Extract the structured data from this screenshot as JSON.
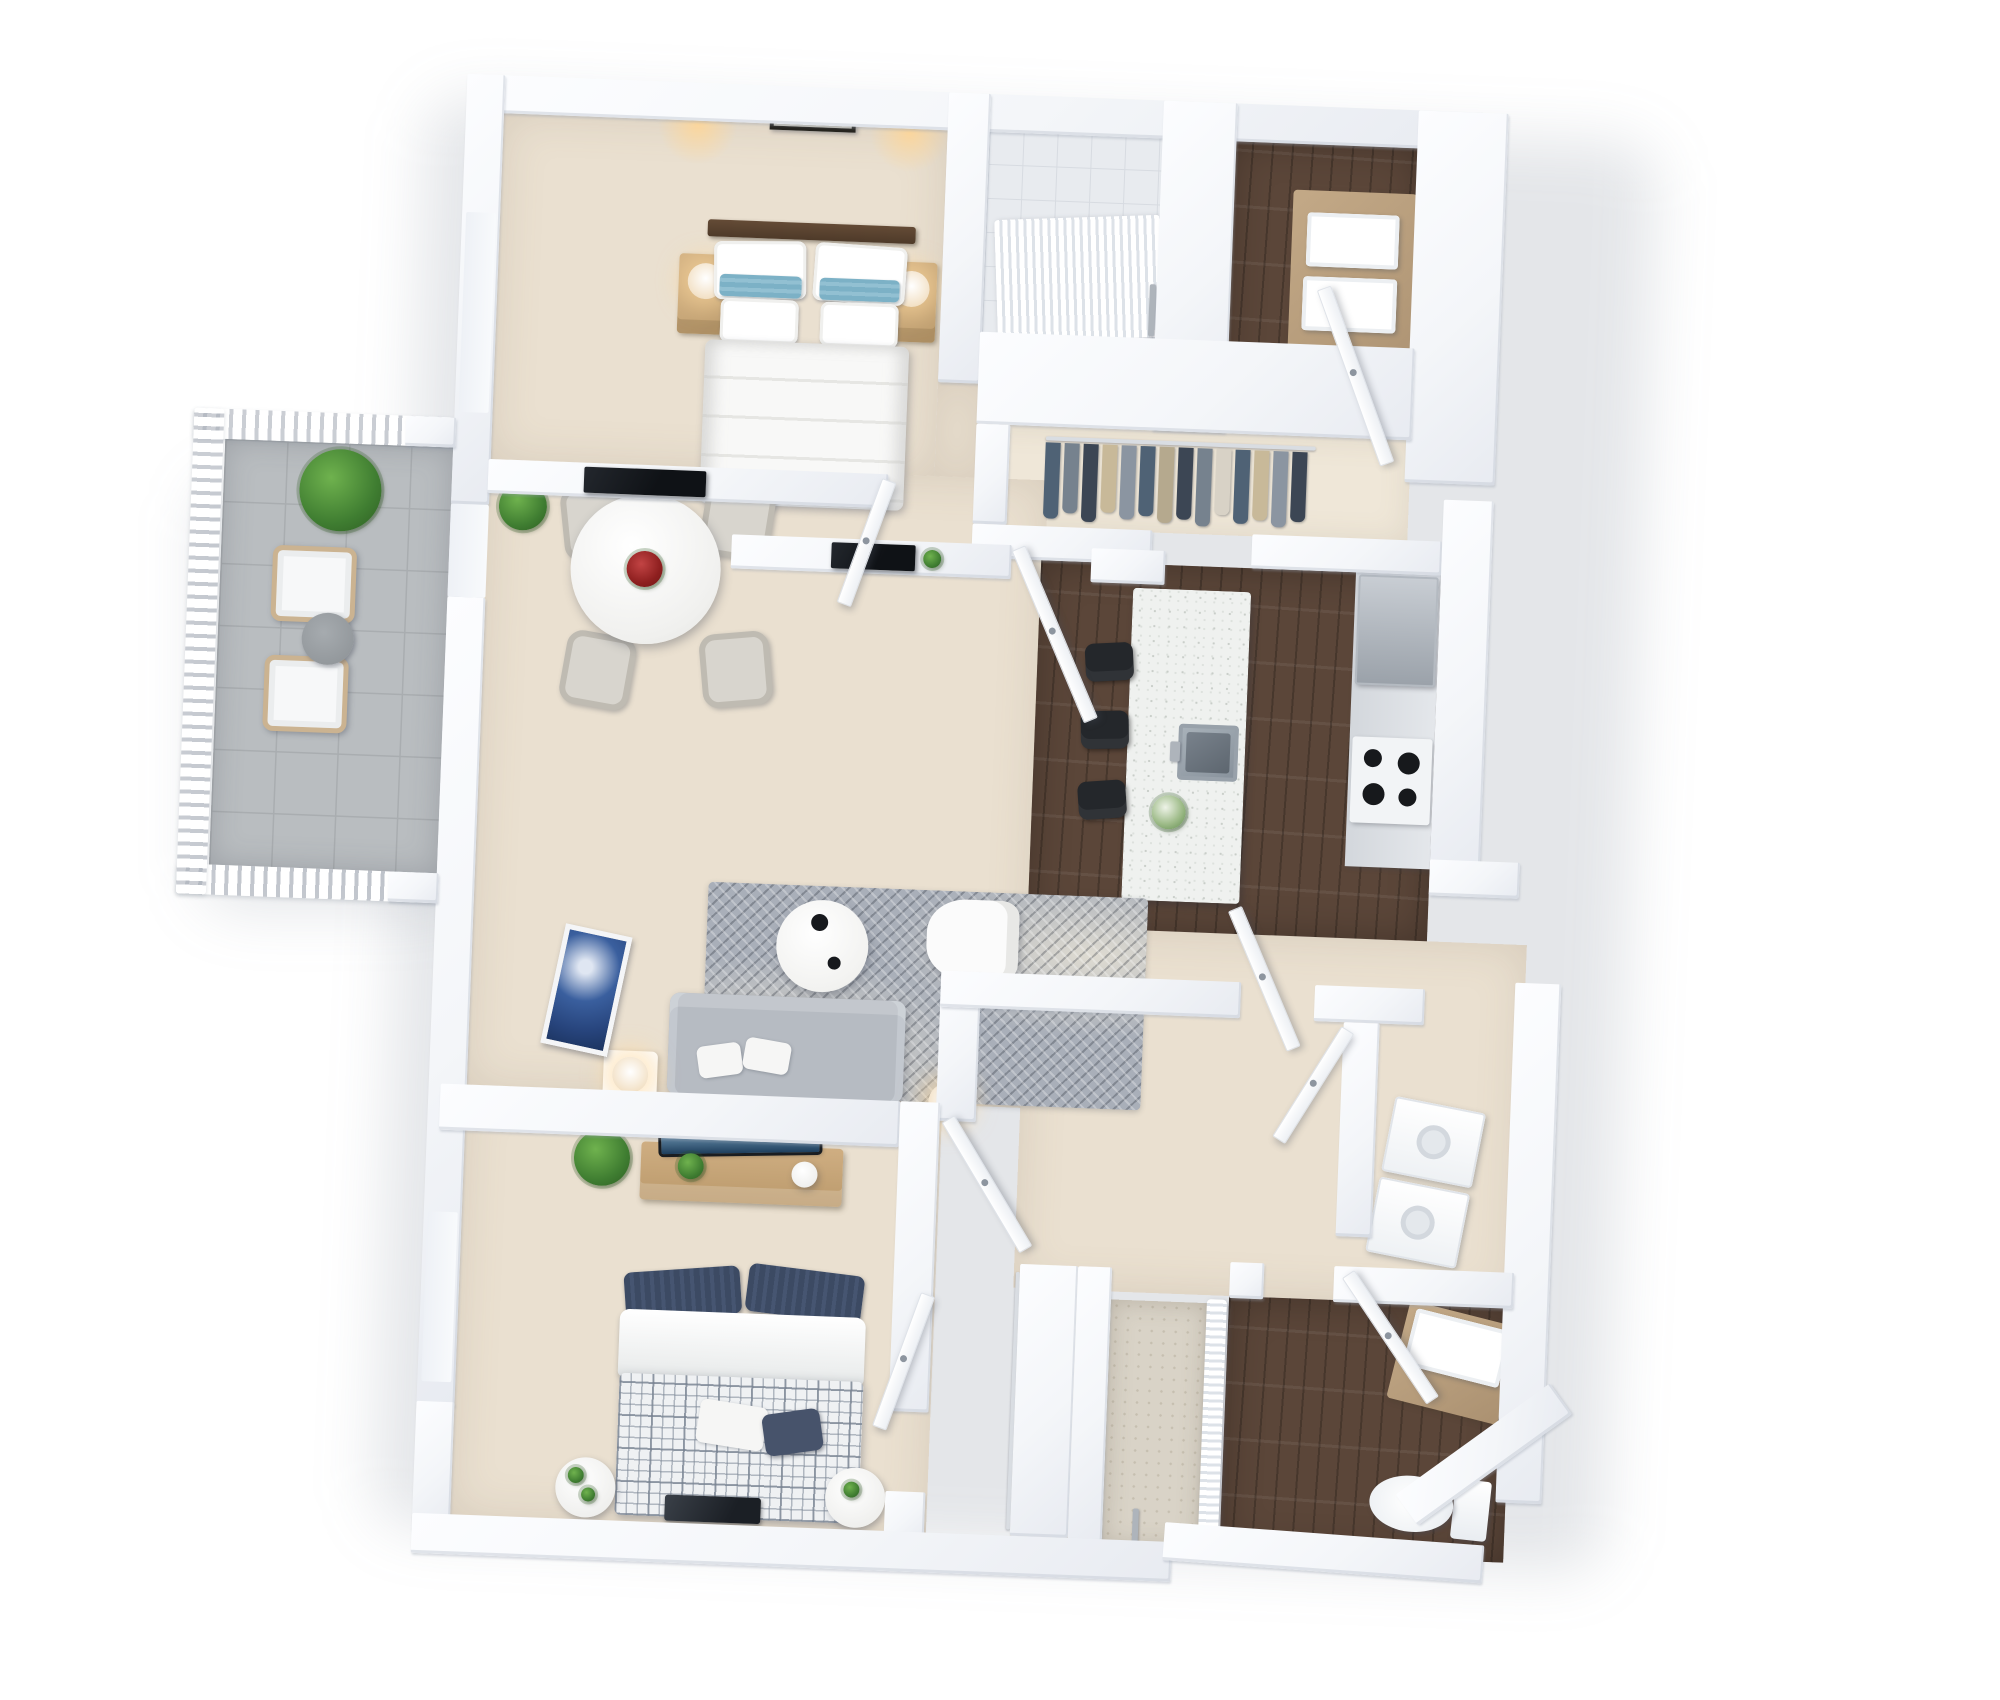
{
  "scene": {
    "title": "3D Apartment Floor Plan Rendering",
    "description": "Top-down isometric 3D render of a two-bedroom, two-bathroom apartment with open living/dining/kitchen area and a balcony, on a plain white background. No text labels are visible in the image.",
    "view": "isometric top-down",
    "background": "#ffffff",
    "rotation_deg": 2.2,
    "bedrooms": 2,
    "bathrooms": 2
  },
  "palette": {
    "wall_white": "#fafbfd",
    "wall_shade": "#e8ebf1",
    "floor_beige": "#eae0d0",
    "floor_beige_light": "#efe7d8",
    "hardwood_dark": "#5b4639",
    "balcony_tile_gray": "#b9bdc0",
    "rug_gray": "#a9afb9",
    "sofa_gray": "#b6bbc2",
    "stool_black": "#24272b",
    "accent_pillow_blue": "#7cb1c6",
    "navy_pillow": "#3c4a63",
    "flower_red": "#9e2020",
    "plant_green": "#3f7d31",
    "lamp_glow": "#f5e3c5",
    "artwork_blue": "#3a5f9e",
    "stainless_steel": "#98a1aa",
    "nightstand_wood": "#c8a878",
    "headboard_wood": "#5a4334",
    "vanity_wood": "#b7a083",
    "closet_garments": [
      "#4f6275",
      "#76828e",
      "#c8b999",
      "#3c4654",
      "#b5a98e",
      "#8b95a1",
      "#d8d2c6"
    ],
    "hall_closet_garments": [
      "#6d5a49",
      "#423c36",
      "#93836c",
      "#2f2b27",
      "#7b6a55"
    ]
  },
  "rooms": [
    {
      "id": "master-bedroom",
      "label": "Master Bedroom",
      "floor": "beige carpet",
      "furniture": [
        "double bed with white duvet",
        "two white pillows per side",
        "blue accent pillows",
        "dark wood headboard",
        "framed artwork above bed",
        "two wall sconces",
        "left wood nightstand with lamp",
        "right wood nightstand with lamp",
        "wall TV on half wall"
      ]
    },
    {
      "id": "master-bathroom",
      "label": "Master Bathroom",
      "floor": "dark hardwood + shower tile",
      "furniture": [
        "walk-in shower with white curtain",
        "shower fixture",
        "wood vanity",
        "two white vessel sinks",
        "door"
      ]
    },
    {
      "id": "walk-in-closet",
      "label": "Walk-in Closet",
      "floor": "beige carpet",
      "furniture": [
        "hanging rod with garments in blue, gray and tan",
        "white shelving header"
      ]
    },
    {
      "id": "kitchen",
      "label": "Kitchen",
      "floor": "dark hardwood",
      "furniture": [
        "white speckled island",
        "stainless undermount sink with faucet",
        "three black bar stools",
        "white flower vase",
        "stainless refrigerator",
        "counter with black cooktop"
      ]
    },
    {
      "id": "dining-area",
      "label": "Dining Area",
      "floor": "beige carpet",
      "furniture": [
        "round white pedestal table",
        "red flower centerpiece",
        "four upholstered beige chairs",
        "potted plant"
      ]
    },
    {
      "id": "living-room",
      "label": "Living Room",
      "floor": "beige carpet",
      "furniture": [
        "gray patterned area rug",
        "gray fabric sofa with two white pillows",
        "round white coffee table with black decor",
        "white accent armchair",
        "side table with lamp",
        "second table lamp",
        "blue canvas artwork",
        "wall TV with small plant",
        "half wall ledge"
      ]
    },
    {
      "id": "balcony",
      "label": "Balcony",
      "floor": "gray tile",
      "furniture": [
        "white slat railing",
        "large potted green plant",
        "two white cushioned lounge chairs",
        "round gray side table"
      ]
    },
    {
      "id": "bedroom-2",
      "label": "Bedroom 2",
      "floor": "beige carpet",
      "furniture": [
        "double bed with navy pillows and checked duvet",
        "white duvet fold",
        "laptop on bed",
        "two round white nightstands with small plants",
        "wood media console",
        "TV with blue screen",
        "potted plant",
        "window"
      ]
    },
    {
      "id": "bathroom-2",
      "label": "Bathroom 2",
      "floor": "dark hardwood + tile shower",
      "furniture": [
        "walk-in shower with curtain",
        "shower fixture",
        "white vanity sink on wood cabinet",
        "toilet",
        "door"
      ]
    },
    {
      "id": "laundry-closet",
      "label": "Laundry Closet",
      "floor": "beige carpet",
      "furniture": [
        "stacked washer and dryer"
      ]
    },
    {
      "id": "hallway",
      "label": "Hallway",
      "floor": "beige carpet",
      "furniture": [
        "entry door",
        "interior swing doors"
      ]
    },
    {
      "id": "hall-closet",
      "label": "Hall Closet",
      "floor": "beige carpet",
      "furniture": [
        "hanging rod with brown and dark garments"
      ]
    }
  ],
  "counts": {
    "bar_stools": 3,
    "dining_chairs": 4,
    "balcony_chairs": 2,
    "master_sinks": 2,
    "doors_visible": 7
  }
}
